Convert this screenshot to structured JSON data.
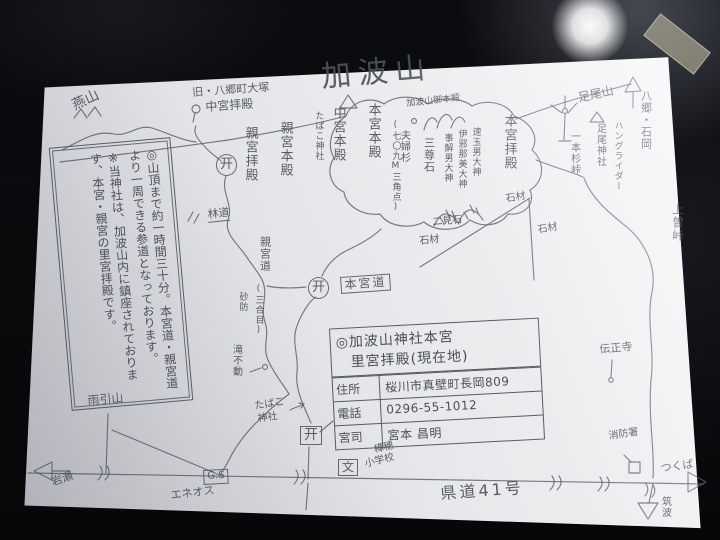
{
  "scene": {
    "background_color": "#0b0c0f",
    "paper_color": "#ebebee",
    "ink_color": "#5a5f67",
    "tape_color": "#cdc4ac",
    "glare_color": "#ffffff"
  },
  "note_box": {
    "line1": "◎山頂まで約一時間三十分。本宮道・親宮道より一周できる参道となっております。",
    "line2": "※当神社は、加波山内に鎮座されております、本宮・親宮の里宮拝殿です。"
  },
  "info_table": {
    "title_line1": "◎加波山神社本宮",
    "title_line2": "里宮拝殿(現在地)",
    "rows": [
      {
        "label": "住所",
        "value": "桜川市真壁町長岡809"
      },
      {
        "label": "電話",
        "value": "0296-55-1012"
      },
      {
        "label": "宮司",
        "value": "宮本 昌明"
      }
    ]
  },
  "icons": [
    {
      "name": "torii-icon",
      "glyph": "开"
    },
    {
      "name": "windmill-icon",
      "glyph": "wind-turbine"
    },
    {
      "name": "peak-triangle-icon",
      "glyph": "△"
    },
    {
      "name": "arrow-icons",
      "glyph": "direction arrows"
    }
  ],
  "map_labels": [
    {
      "id": "kabasan-title",
      "text": "加波山",
      "x": 320,
      "y": 62,
      "size": 30,
      "rot": -5,
      "ls": 7
    },
    {
      "id": "tsubakuro-yama",
      "text": "燕山",
      "x": 70,
      "y": 100,
      "size": 14,
      "rot": -25
    },
    {
      "id": "kyu-yasato-otsuka",
      "text": "旧・八郷町大塚",
      "x": 192,
      "y": 87,
      "size": 11,
      "rot": -4
    },
    {
      "id": "chugu-haiden",
      "text": "中宮拝殿",
      "x": 205,
      "y": 101,
      "size": 12,
      "rot": -4
    },
    {
      "id": "torii-chugu",
      "text": "开",
      "x": 216,
      "y": 154,
      "size": 13,
      "circled": true
    },
    {
      "id": "shingu-haiden",
      "text": "親宮拝殿",
      "x": 243,
      "y": 126,
      "size": 13,
      "vertical": true
    },
    {
      "id": "shingu-honden",
      "text": "親宮本殿",
      "x": 278,
      "y": 121,
      "size": 13,
      "vertical": true
    },
    {
      "id": "tabako-jinja-upper",
      "text": "たばこ神社",
      "x": 313,
      "y": 111,
      "size": 9,
      "vertical": true
    },
    {
      "id": "chugu-honden",
      "text": "中宮本殿",
      "x": 331,
      "y": 106,
      "size": 13,
      "vertical": true
    },
    {
      "id": "hongu-honden",
      "text": "本宮本殿",
      "x": 366,
      "y": 103,
      "size": 13,
      "vertical": true
    },
    {
      "id": "sankakuten-709m",
      "text": "(七〇九M三角点)",
      "x": 390,
      "y": 120,
      "size": 9,
      "vertical": true
    },
    {
      "id": "meoto-sugi",
      "text": "夫婦杉",
      "x": 398,
      "y": 130,
      "size": 10,
      "vertical": true
    },
    {
      "id": "sanzonseki",
      "text": "三尊石",
      "x": 423,
      "y": 137,
      "size": 11,
      "vertical": true
    },
    {
      "id": "kabasan-gohonden",
      "text": "加波山御本殿",
      "x": 406,
      "y": 100,
      "size": 9,
      "rot": -6
    },
    {
      "id": "deity-kotosakao",
      "text": "事解男大神",
      "x": 442,
      "y": 133,
      "size": 9,
      "vertical": true
    },
    {
      "id": "deity-izanami",
      "text": "伊邪那美大神",
      "x": 456,
      "y": 129,
      "size": 9,
      "vertical": true
    },
    {
      "id": "deity-hayatamao",
      "text": "速玉男大神",
      "x": 470,
      "y": 127,
      "size": 9,
      "vertical": true
    },
    {
      "id": "hongu-haiden",
      "text": "本宮拝殿",
      "x": 502,
      "y": 114,
      "size": 13,
      "vertical": true
    },
    {
      "id": "futami-ishi",
      "text": "二見石",
      "x": 432,
      "y": 218,
      "size": 10,
      "rot": -5
    },
    {
      "id": "sekizai-upper",
      "text": "石材",
      "x": 505,
      "y": 195,
      "size": 10,
      "rot": -10
    },
    {
      "id": "sekizai-right",
      "text": "石材",
      "x": 537,
      "y": 226,
      "size": 10,
      "rot": -10
    },
    {
      "id": "sekizai-lower",
      "text": "石材",
      "x": 419,
      "y": 237,
      "size": 10,
      "rot": -6
    },
    {
      "id": "ashio-san",
      "text": "足尾山",
      "x": 577,
      "y": 92,
      "size": 12,
      "rot": -12
    },
    {
      "id": "ashio-jinja",
      "text": "足尾神社",
      "x": 594,
      "y": 123,
      "size": 10,
      "vertical": true
    },
    {
      "id": "hang-glider",
      "text": "ハングライダー",
      "x": 612,
      "y": 121,
      "size": 9,
      "vertical": true
    },
    {
      "id": "ipponsugi-toge",
      "text": "一本杉峠",
      "x": 568,
      "y": 131,
      "size": 10,
      "vertical": true
    },
    {
      "id": "yasato-ishioka",
      "text": "八郷・石岡",
      "x": 640,
      "y": 90,
      "size": 11,
      "vertical": true
    },
    {
      "id": "uwaso-toge",
      "text": "上曽峠",
      "x": 671,
      "y": 203,
      "size": 12,
      "vertical": true
    },
    {
      "id": "denshoji",
      "text": "伝正寺",
      "x": 599,
      "y": 344,
      "size": 11,
      "rot": -5
    },
    {
      "id": "shobosho",
      "text": "消防署",
      "x": 608,
      "y": 432,
      "size": 10,
      "rot": -8
    },
    {
      "id": "tsukuba-kana",
      "text": "つくば",
      "x": 660,
      "y": 463,
      "size": 11,
      "rot": -8
    },
    {
      "id": "tsukuba-kanji",
      "text": "筑波",
      "x": 659,
      "y": 496,
      "size": 10,
      "vertical": true
    },
    {
      "id": "kendo-41",
      "text": "県道41号",
      "x": 440,
      "y": 486,
      "size": 16,
      "rot": -4,
      "ls": 3
    },
    {
      "id": "iwase",
      "text": "岩瀬",
      "x": 50,
      "y": 477,
      "size": 11,
      "rot": -18
    },
    {
      "id": "amabiki-yama",
      "text": "雨引山",
      "x": 87,
      "y": 395,
      "size": 12,
      "rot": -5
    },
    {
      "id": "rindo",
      "text": "林道",
      "x": 207,
      "y": 209,
      "size": 11,
      "rot": -6,
      "underline": true
    },
    {
      "id": "shingu-do",
      "text": "親宮道",
      "x": 259,
      "y": 236,
      "size": 11,
      "vertical": true
    },
    {
      "id": "sangome",
      "text": "(三合目)",
      "x": 253,
      "y": 284,
      "size": 9,
      "vertical": true
    },
    {
      "id": "sabo",
      "text": "砂防",
      "x": 237,
      "y": 292,
      "size": 9,
      "vertical": true
    },
    {
      "id": "taki-fudo",
      "text": "滝不動",
      "x": 230,
      "y": 344,
      "size": 10,
      "vertical": true
    },
    {
      "id": "tabako-jinja-lower-1",
      "text": "たばこ",
      "x": 254,
      "y": 402,
      "size": 10,
      "rot": -9
    },
    {
      "id": "tabako-jinja-lower-2",
      "text": "神社",
      "x": 257,
      "y": 415,
      "size": 10,
      "rot": -9
    },
    {
      "id": "torii-center",
      "text": "开",
      "x": 308,
      "y": 277,
      "size": 13,
      "circled": true
    },
    {
      "id": "hongu-do",
      "text": "本宮道",
      "x": 340,
      "y": 277,
      "size": 12,
      "boxed": true,
      "rot": -4,
      "ls": 2
    },
    {
      "id": "torii-satomiya",
      "text": "开",
      "x": 300,
      "y": 426,
      "size": 14,
      "boxed": true
    },
    {
      "id": "gs-station",
      "text": "G.S",
      "x": 203,
      "y": 470,
      "size": 10,
      "boxed": true,
      "rot": -3
    },
    {
      "id": "eneos",
      "text": "エネオス",
      "x": 170,
      "y": 490,
      "size": 11,
      "rot": -7
    },
    {
      "id": "school-mark",
      "text": "文",
      "x": 338,
      "y": 459,
      "size": 12,
      "boxed": true
    },
    {
      "id": "kabaho-sho-1",
      "text": "樺穂",
      "x": 373,
      "y": 446,
      "size": 10,
      "rot": -14
    },
    {
      "id": "kabaho-sho-2",
      "text": "小学校",
      "x": 364,
      "y": 460,
      "size": 10,
      "rot": -14
    }
  ]
}
